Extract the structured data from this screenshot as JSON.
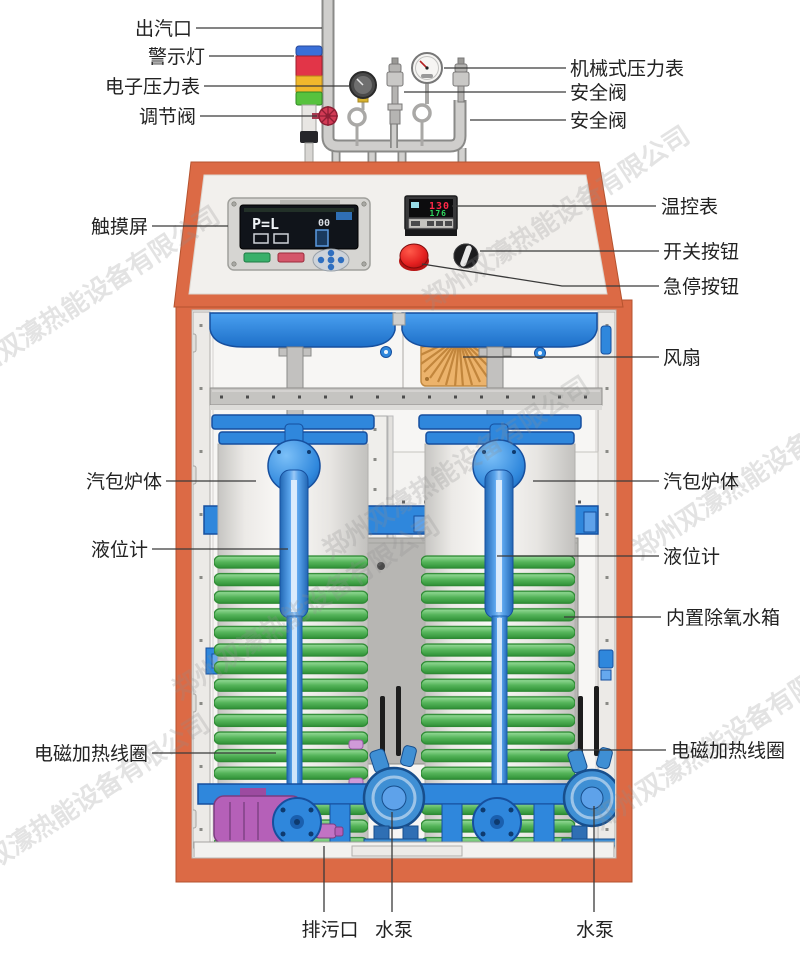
{
  "watermark": {
    "text": "郑州双濠热能设备有限公司"
  },
  "labels": {
    "steam_outlet": "出汽口",
    "warning_light": "警示灯",
    "electronic_pressure_gauge": "电子压力表",
    "regulating_valve": "调节阀",
    "touch_screen": "触摸屏",
    "drum_body_left": "汽包炉体",
    "level_gauge_left": "液位计",
    "heating_coil_left": "电磁加热线圈",
    "drain_outlet": "排污口",
    "water_pump_left": "水泵",
    "water_pump_right": "水泵",
    "mechanical_pressure_gauge": "机械式压力表",
    "safety_valve_top": "安全阀",
    "safety_valve_bottom": "安全阀",
    "temperature_controller": "温控表",
    "switch_button": "开关按钮",
    "emergency_stop_button": "急停按钮",
    "fan": "风扇",
    "drum_body_right": "汽包炉体",
    "level_gauge_right": "液位计",
    "deaerator_tank": "内置除氧水箱",
    "heating_coil_right": "电磁加热线圈"
  },
  "touch_screen_display": {
    "main": "P=L",
    "sub": "00"
  },
  "temperature_controller_display": {
    "pv": "130",
    "sv": "176"
  },
  "colors": {
    "frame_orange": "#dc6a45",
    "machine_blue": "#2f87dc",
    "coil_green": "#55b45a",
    "warning_red": "#e23548",
    "warning_yellow": "#f0b82c",
    "warning_green": "#57c23e",
    "estop_red": "#e02020",
    "fan_orange": "#ecb36b",
    "pump_purple": "#b560b8"
  }
}
